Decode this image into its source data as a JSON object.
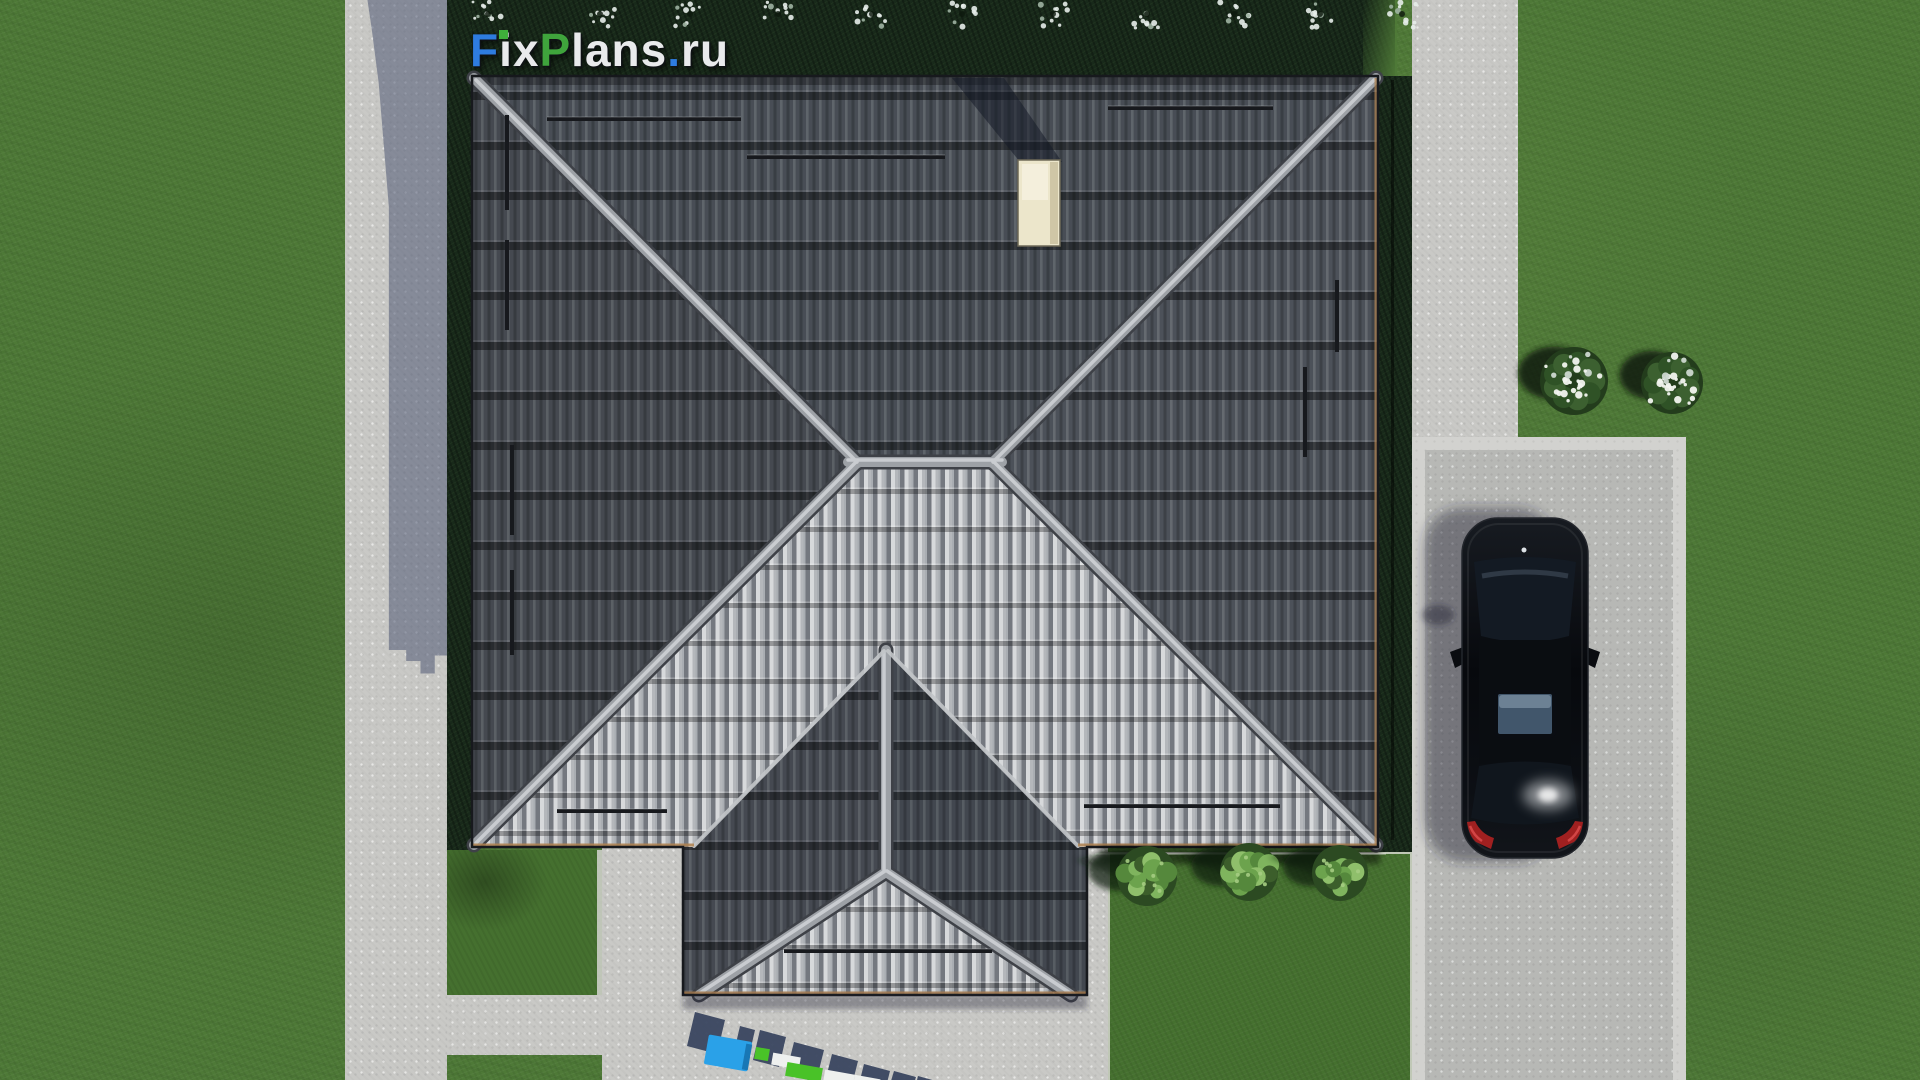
{
  "brand": {
    "logo_text": "FixPlans.ru",
    "logo_letters": [
      {
        "ch": "F",
        "color": "#2e7ce0"
      },
      {
        "ch": "i",
        "color": "#e9eaec",
        "dot_color": "#3fae3b"
      },
      {
        "ch": "x",
        "color": "#e9eaec"
      },
      {
        "ch": "P",
        "color": "#3fa43c"
      },
      {
        "ch": "l",
        "color": "#e9eaec"
      },
      {
        "ch": "a",
        "color": "#e9eaec"
      },
      {
        "ch": "n",
        "color": "#e9eaec"
      },
      {
        "ch": "s",
        "color": "#e9eaec"
      },
      {
        "ch": ".",
        "color": "#2e7ce0"
      },
      {
        "ch": "r",
        "color": "#e9eaec"
      },
      {
        "ch": "u",
        "color": "#e9eaec"
      }
    ]
  },
  "watermark": {
    "text": "FixPlans.ru"
  },
  "palette": {
    "brand_blue": "#2e7ce0",
    "brand_green": "#3fa43c",
    "watermark_blue": "#2aa1e8",
    "watermark_green": "#49c228",
    "grass": "#4e7937",
    "grass_shadow": "#18291a",
    "concrete": "#c9c9c6",
    "roof_dark_tile": "#4c5159",
    "roof_light_tile": "#a2a6ac",
    "ridge": "#9da1a6",
    "eave_fascia": "#b0824f",
    "skylight": "#ece6cb",
    "car_body": "#0a0d11",
    "car_taillight": "#a02020"
  }
}
